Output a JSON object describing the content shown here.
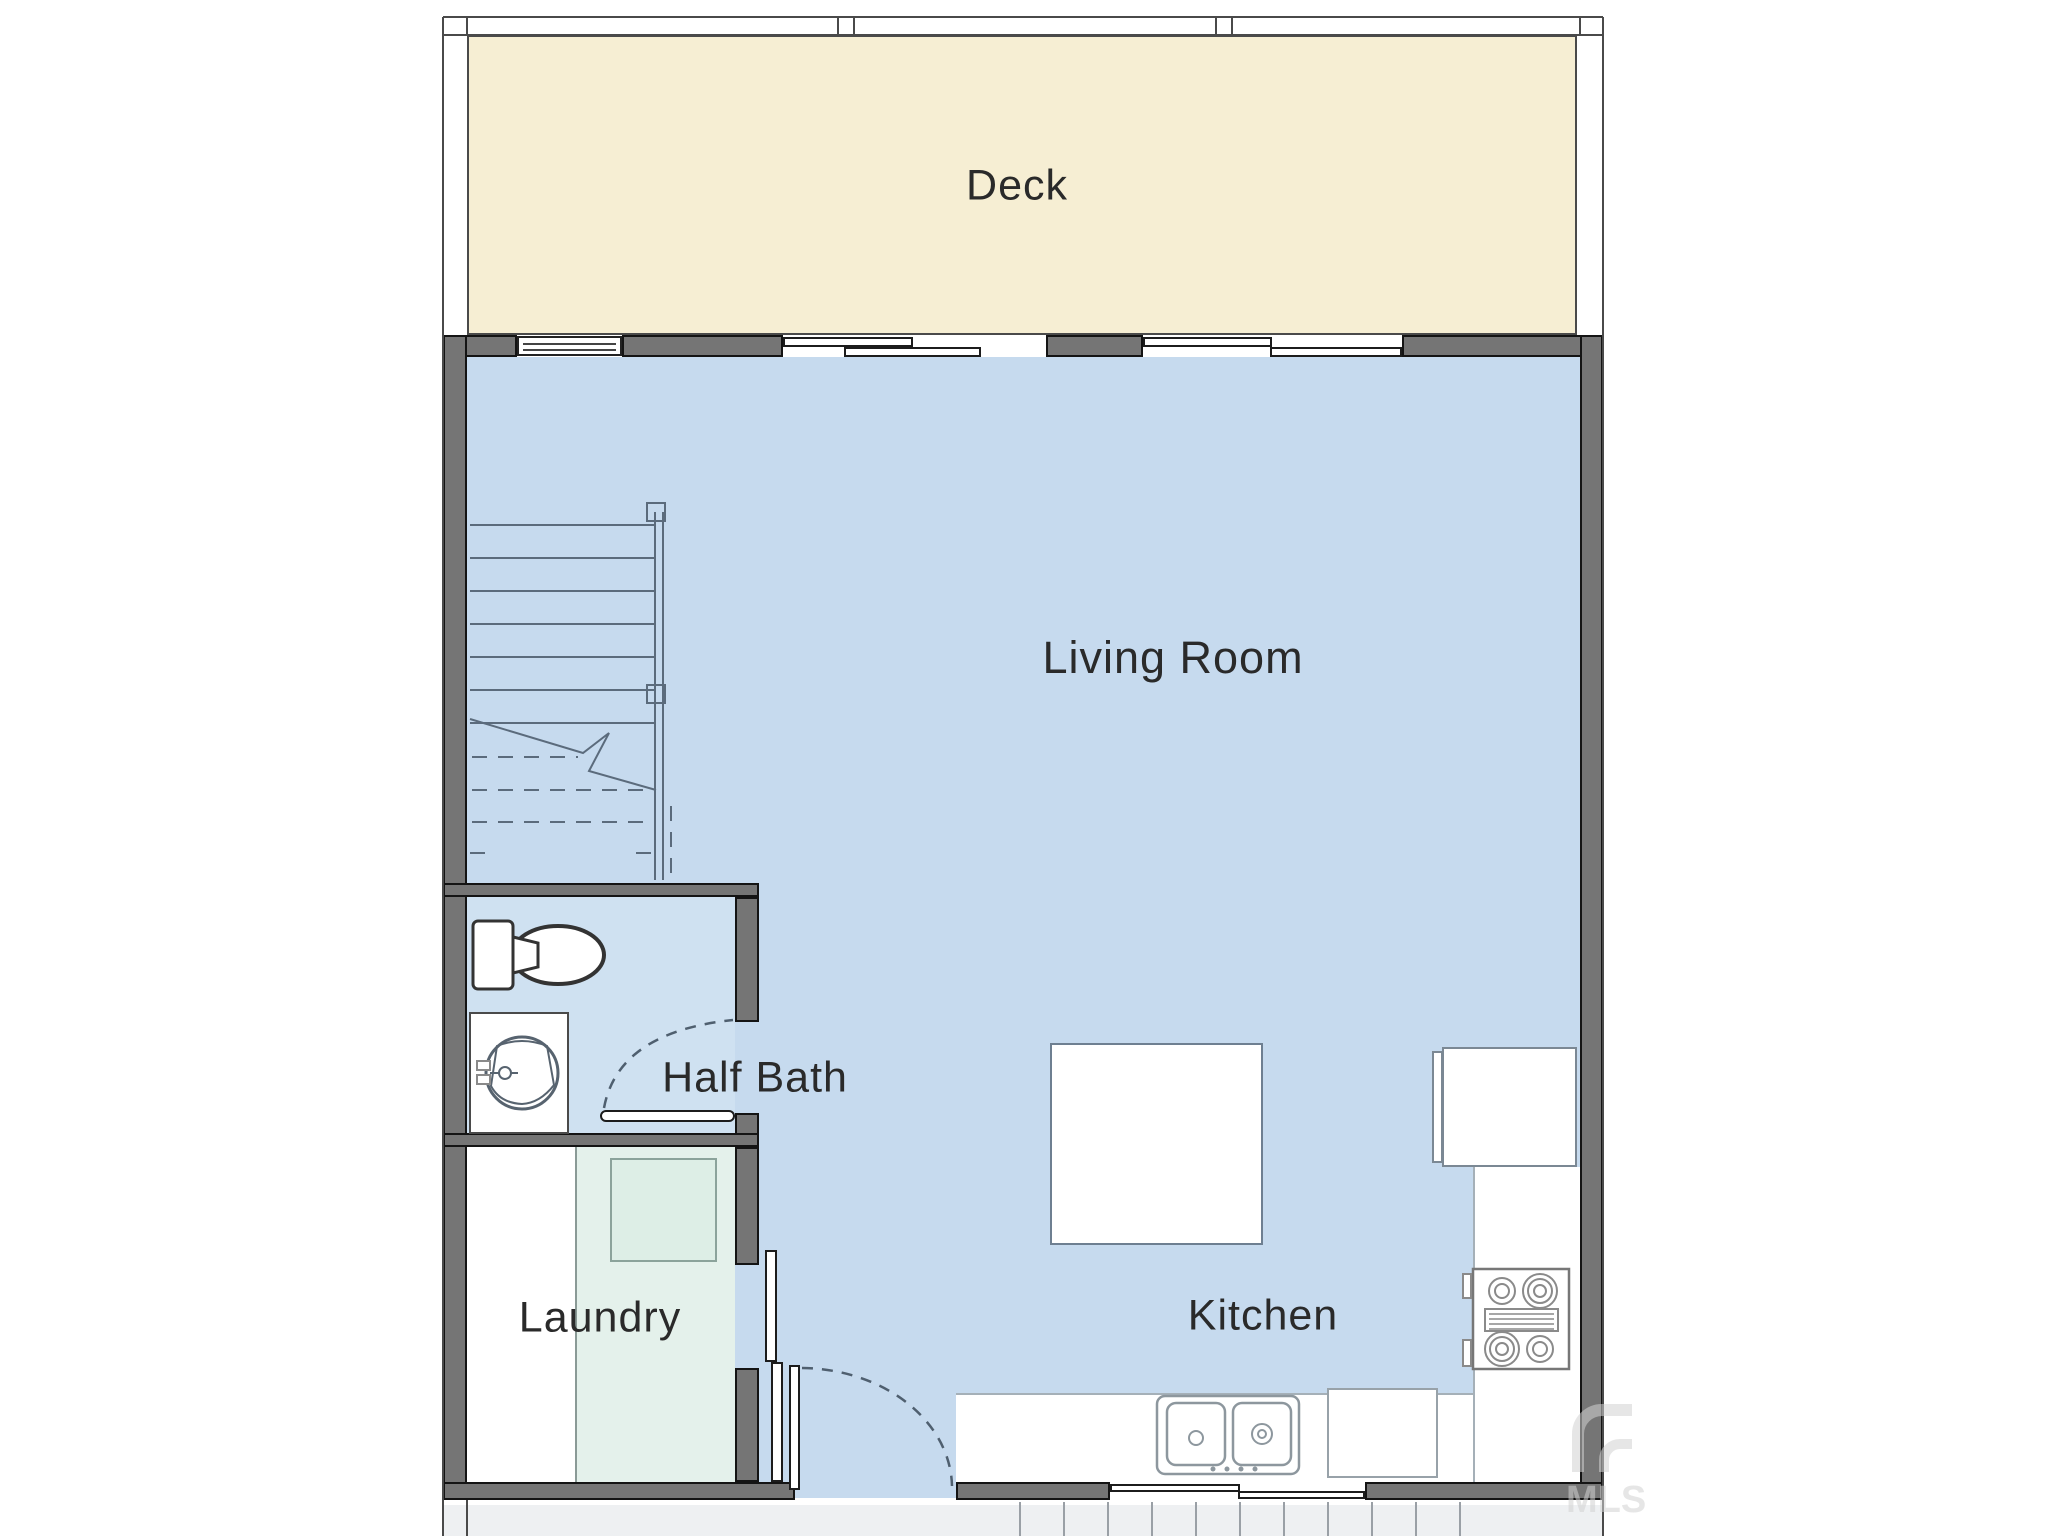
{
  "plan": {
    "rooms": {
      "deck": {
        "label": "Deck"
      },
      "living_room": {
        "label": "Living Room"
      },
      "half_bath": {
        "label": "Half Bath"
      },
      "laundry": {
        "label": "Laundry"
      },
      "kitchen": {
        "label": "Kitchen"
      }
    },
    "fixtures": {
      "staircase": "staircase-with-railing-and-break-line",
      "toilet": "toilet-icon",
      "sink": "pedestal-sink-icon",
      "washer": "washer-icon",
      "island": "kitchen-island",
      "refrigerator": "refrigerator",
      "range": "range-with-four-burners",
      "kitchen_sink": "double-basin-sink",
      "dishwasher": "dishwasher"
    },
    "watermark": {
      "text": "MLS"
    }
  },
  "palette": {
    "deck_fill": "#f6eed3",
    "floor_fill": "#c6daee",
    "half_bath_fill": "#cfe1f1",
    "laundry_fill": "#e4f1eb",
    "appliance_fill": "#ddeee6",
    "wall_fill": "#757575",
    "wall_outline": "#141414",
    "line_color": "#5b6b7c",
    "exterior_band": "#eef0f2",
    "text_color": "#2a2a2a",
    "watermark_color": "#d2d2d2"
  }
}
